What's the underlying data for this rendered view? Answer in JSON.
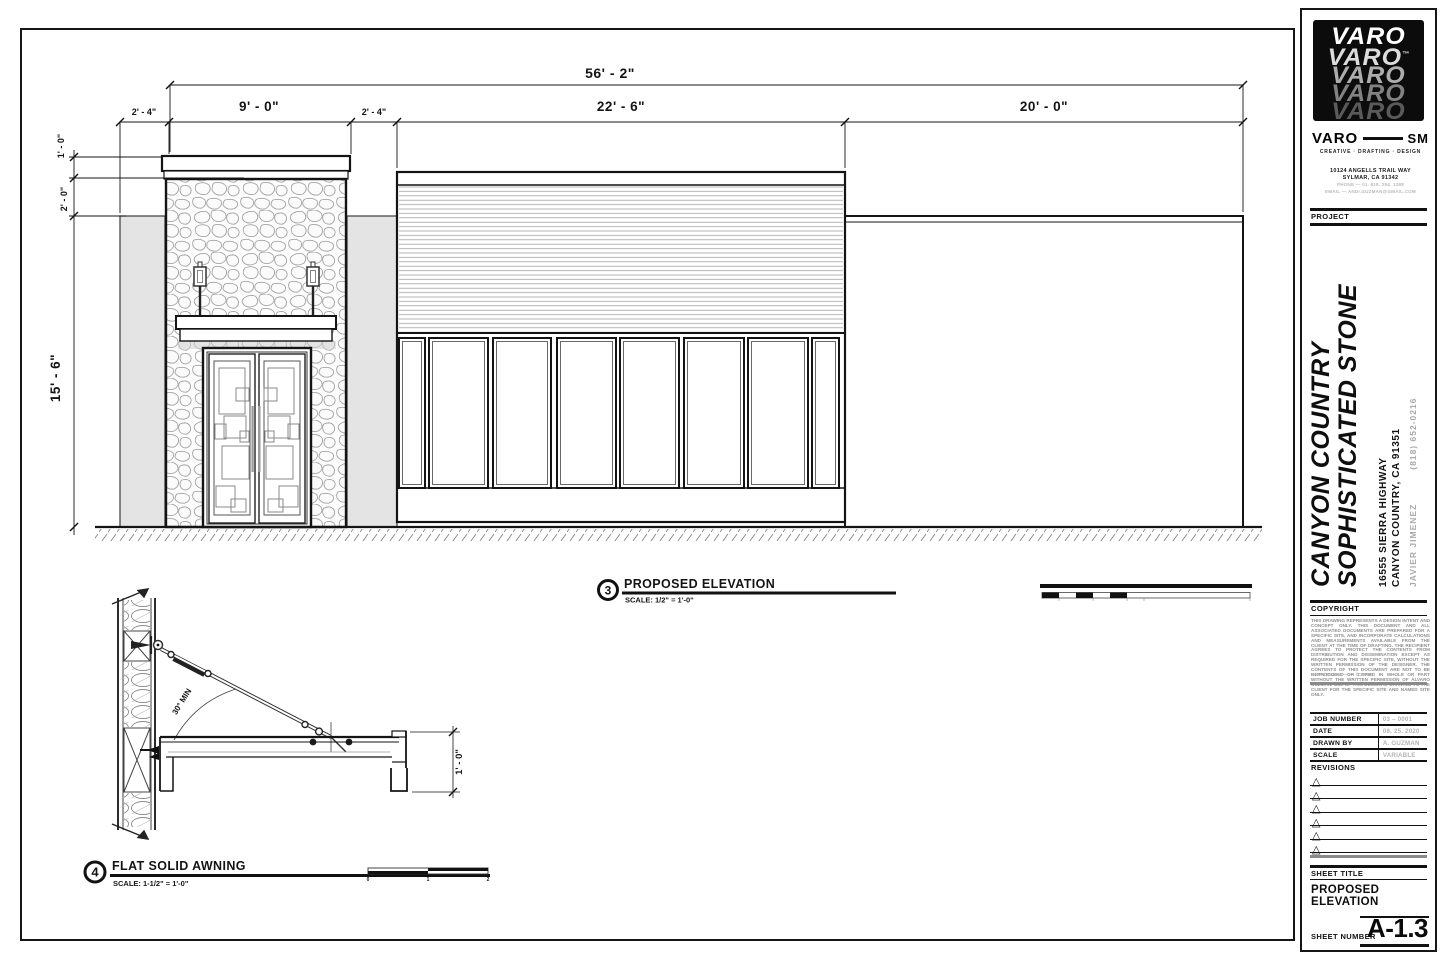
{
  "sheet": {
    "elevation": {
      "callout_number": "3",
      "title": "PROPOSED ELEVATION",
      "scale": "SCALE:  1/2\" = 1'-0\"",
      "dims": {
        "overall": "56' - 2\"",
        "segments": [
          "2' - 4\"",
          "9' - 0\"",
          "2' - 4\"",
          "22' - 6\"",
          "20' - 0\""
        ],
        "verticals": [
          "1' - 0\"",
          "2' - 0\"",
          "15' - 6\""
        ]
      }
    },
    "detail": {
      "callout_number": "4",
      "title": "FLAT SOLID AWNING",
      "scale": "SCALE:  1-1/2\" = 1'-0\"",
      "angle_note": "30° MIN",
      "height_dim": "1' - 0\"",
      "scale_bar_ticks": [
        "0",
        "1",
        "2"
      ]
    },
    "titleblock": {
      "logo_text": "VARO",
      "logo_tm": "™",
      "brand_left": "VARO",
      "brand_right": "SM",
      "tagline": "CREATIVE · DRAFTING · DESIGN",
      "address1": "10124 ANGELLS TRAIL WAY",
      "address2": "SYLMAR, CA 91342",
      "phone": "PHONE — 01. 818. 254. 1388",
      "email": "EMAIL — ANDI.GUZMAN@GMAIL.COM",
      "project_label": "PROJECT",
      "project_name_line1": "CANYON COUNTRY",
      "project_name_line2": "SOPHISTICATED STONE",
      "project_address_line1": "16555 SIERRA HIGHWAY",
      "project_address_line2": "CANYON COUNTRY, CA 91351",
      "contact_name": "JAVIER JIMENEZ",
      "contact_phone": "(818) 652-0216",
      "copyright_label": "COPYRIGHT",
      "copyright_text": "THIS DRAWING REPRESENTS A DESIGN INTENT AND CONCEPT ONLY. THIS DOCUMENT AND ALL ASSOCIATED DOCUMENTS ARE PREPARED FOR A SPECIFIC SITE, AND INCORPORATE CALCULATIONS AND MEASUREMENTS AVAILABLE FROM THE CLIENT AT THE TIME OF DRAFTING. THE RECIPIENT AGREES TO PROTECT THE CONTENTS FROM DISTRIBUTION AND DISSEMINATION EXCEPT AS REQUIRED FOR THE SPECIFIC SITE, WITHOUT THE WRITTEN PERMISSION OF THE DESIGNER. THE CONTENTS OF THIS DOCUMENT ARE NOT TO BE REPRODUCED OR COPIED IN WHOLE OR PART WITHOUT THE WRITTEN PERMISSION OF ÁLVARO GUZMAN. USE OF THIS DESIGN IS GRANTED TO THE CLIENT FOR THE SPECIFIC SITE AND NAMED SITE ONLY.",
      "copyright_year": "COPYRIGHT —— © 2020",
      "fields": [
        {
          "label": "JOB NUMBER",
          "value": "03 – 0001"
        },
        {
          "label": "DATE",
          "value": "08. 25. 2020"
        },
        {
          "label": "DRAWN BY",
          "value": "A. GUZMAN"
        },
        {
          "label": "SCALE",
          "value": "VARIABLE"
        }
      ],
      "revisions_label": "REVISIONS",
      "revision_marker": "△",
      "sheet_title_label": "SHEET TITLE",
      "sheet_title": "PROPOSED ELEVATION",
      "sheet_number_label": "SHEET NUMBER",
      "sheet_number": "A-1.3"
    }
  }
}
